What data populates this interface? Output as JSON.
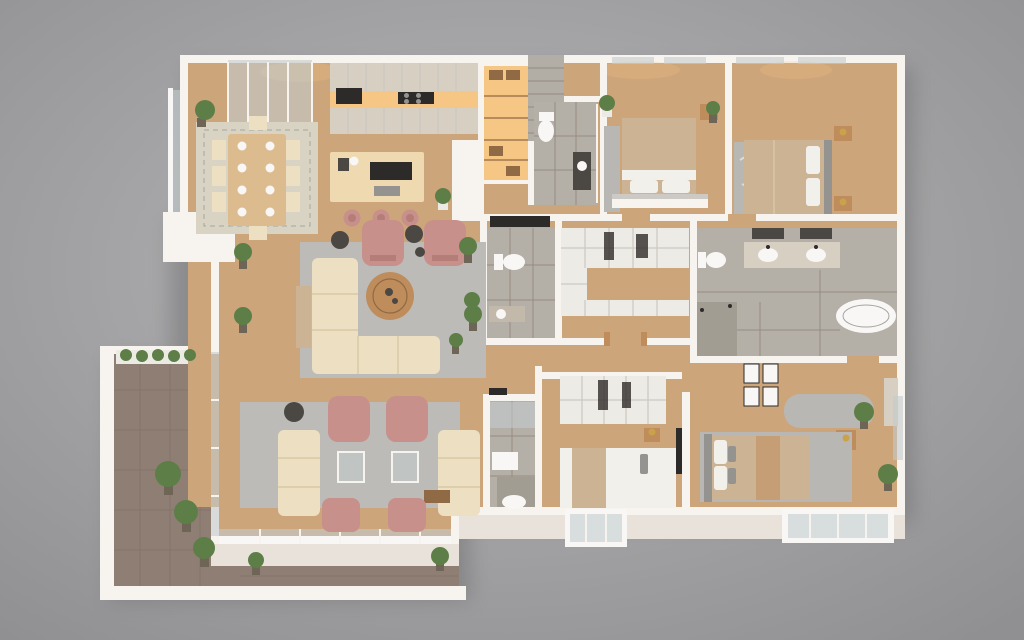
{
  "scene": {
    "type": "3d-floor-plan-render",
    "view": "top-down three-quarter isometric",
    "description": "Photoreal 3D floor plan of a large apartment with wrap-around balcony",
    "background": {
      "center": "#b7b7b9",
      "edge": "#909092"
    }
  },
  "palette": {
    "shadow": "#69696b",
    "wallWhite": "#f7f3ee",
    "wallFace": "#e9e2da",
    "wallGrayTop": "#cdc9c4",
    "floorWood": "#cda57b",
    "balconyTile": "#8f7e73",
    "grout": "#7c6c62",
    "tileGray": "#b5b0a7",
    "tileDark": "#a29d93",
    "marble": "#b2aea6",
    "rugGray": "#bcbbb7",
    "rugBeige": "#d9d3c3",
    "rugLine": "#a5a4a0",
    "sofaCream": "#ecdfc2",
    "sofaShade": "#d9c8a4",
    "pink": "#c8908b",
    "pinkDark": "#b47d78",
    "wood": "#bf8c5c",
    "woodDark": "#8f6a44",
    "diningTable": "#dcbc8e",
    "greige": "#d7cfc2",
    "greigeDark": "#c2b9ab",
    "glow": "#f6c784",
    "island": "#eed9b0",
    "closet": "#edebe6",
    "closetLine": "#ccc9c2",
    "bedTan": "#ccb394",
    "bedWhite": "#f2f0eb",
    "gray1": "#95938f",
    "gray2": "#b9b7b3",
    "white": "#f8f7f5",
    "black": "#2d2b29",
    "dark": "#4b4844",
    "glass": "#c3cccd",
    "green": "#5e7e48",
    "potW": "#eceae4",
    "potD": "#6f6557",
    "gold": "#c9a24a"
  },
  "rooms": [
    {
      "name": "dining-area",
      "items": [
        "wood dining table",
        "8 cream chairs",
        "white place settings",
        "beige area rug",
        "potted plant"
      ]
    },
    {
      "name": "kitchen",
      "items": [
        "greige wall cabinets",
        "warm under-cabinet lighting",
        "black oven",
        "gas cooktop",
        "cream island with black hob",
        "3 pink bar stools",
        "coffee maker"
      ]
    },
    {
      "name": "entry-hall",
      "items": [
        "backlit shelving cabinet",
        "marble accent wall",
        "white niche wall",
        "potted plant"
      ]
    },
    {
      "name": "hall-bathroom",
      "items": [
        "toilet",
        "dark vanity with sink",
        "glass door",
        "gray tile floor"
      ]
    },
    {
      "name": "living-room",
      "items": [
        "L-shaped cream sectional",
        "round wood coffee table",
        "2 pink armchairs",
        "dark side tables",
        "gray rug",
        "wall TV",
        "tan bench",
        "potted palms"
      ]
    },
    {
      "name": "family-lounge",
      "items": [
        "2 cream sofas",
        "2 pink armchairs",
        "2 pink slipper chairs",
        "glass side tables",
        "wood coffee table",
        "gray rug",
        "glass wall to balcony"
      ]
    },
    {
      "name": "balcony",
      "items": [
        "white baluster railing",
        "planter box",
        "large potted plants",
        "brown tile floor",
        "glass sliding wall"
      ]
    },
    {
      "name": "powder-room",
      "items": [
        "toilet",
        "sink counter",
        "potted plant",
        "gray tile floor"
      ]
    },
    {
      "name": "walk-in-closet",
      "items": [
        "U-shaped white wardrobe",
        "hanging clothes",
        "cubby shelving"
      ]
    },
    {
      "name": "bedroom-1",
      "items": [
        "double bed with tan duvet",
        "partition headboard wall",
        "nightstand with gold lamp",
        "runner rug",
        "plant",
        "two windows"
      ]
    },
    {
      "name": "bedroom-2",
      "items": [
        "double bed with tan duvet",
        "dark headboard",
        "2 nightstands with gold lamps",
        "patterned gray rug",
        "two windows"
      ]
    },
    {
      "name": "master-bathroom",
      "items": [
        "double vanity with 2 mirrors",
        "2 white sinks",
        "toilet",
        "dark tiled walk-in shower",
        "freestanding white bathtub"
      ]
    },
    {
      "name": "master-suite",
      "items": [
        "double bed",
        "gray chaise lounge",
        "gallery wall of 4 frames",
        "side table with gold lamp",
        "dresser",
        "large gray rug",
        "plants",
        "bay window"
      ]
    },
    {
      "name": "bedroom-3",
      "items": [
        "double bed with white and tan bedding",
        "open wardrobe with clothes",
        "wall TV",
        "nightstand with gold lamp",
        "bay window"
      ]
    },
    {
      "name": "bathroom-3",
      "items": [
        "glass shower screen",
        "white sink",
        "bath mat",
        "gray tile floor"
      ]
    }
  ]
}
